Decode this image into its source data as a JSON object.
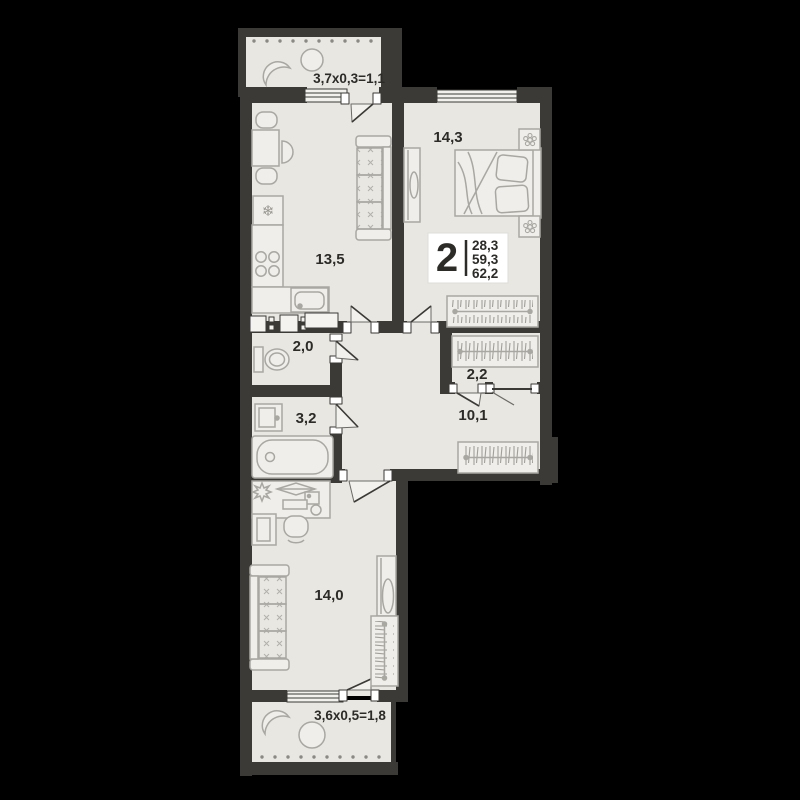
{
  "plan": {
    "title": "2-room apartment floor plan",
    "unit_badge": {
      "rooms": "2",
      "area_1": "28,3",
      "area_2": "59,3",
      "area_3": "62,2"
    },
    "rooms": {
      "kitchen": {
        "area": "13,5"
      },
      "bedroom": {
        "area": "14,3"
      },
      "bathroom_small": {
        "area": "2,0"
      },
      "bathroom": {
        "area": "3,2"
      },
      "corridor": {
        "area": "10,1"
      },
      "closet": {
        "area": "2,2"
      },
      "living_room": {
        "area": "14,0"
      },
      "balcony_top": {
        "area": "3,7х0,3=1,1"
      },
      "balcony_bottom": {
        "area": "3,6х0,5=1,8"
      }
    },
    "icons": {
      "fridge_snowflake": "❄"
    },
    "colors": {
      "background": "#000000",
      "wall": "#3b3a37",
      "floor": "#e9e7e2",
      "furniture_line": "#a9a7a1",
      "furniture_fill": "#efeeea",
      "text": "#2c2b28",
      "badge_bg": "#ffffff"
    }
  }
}
